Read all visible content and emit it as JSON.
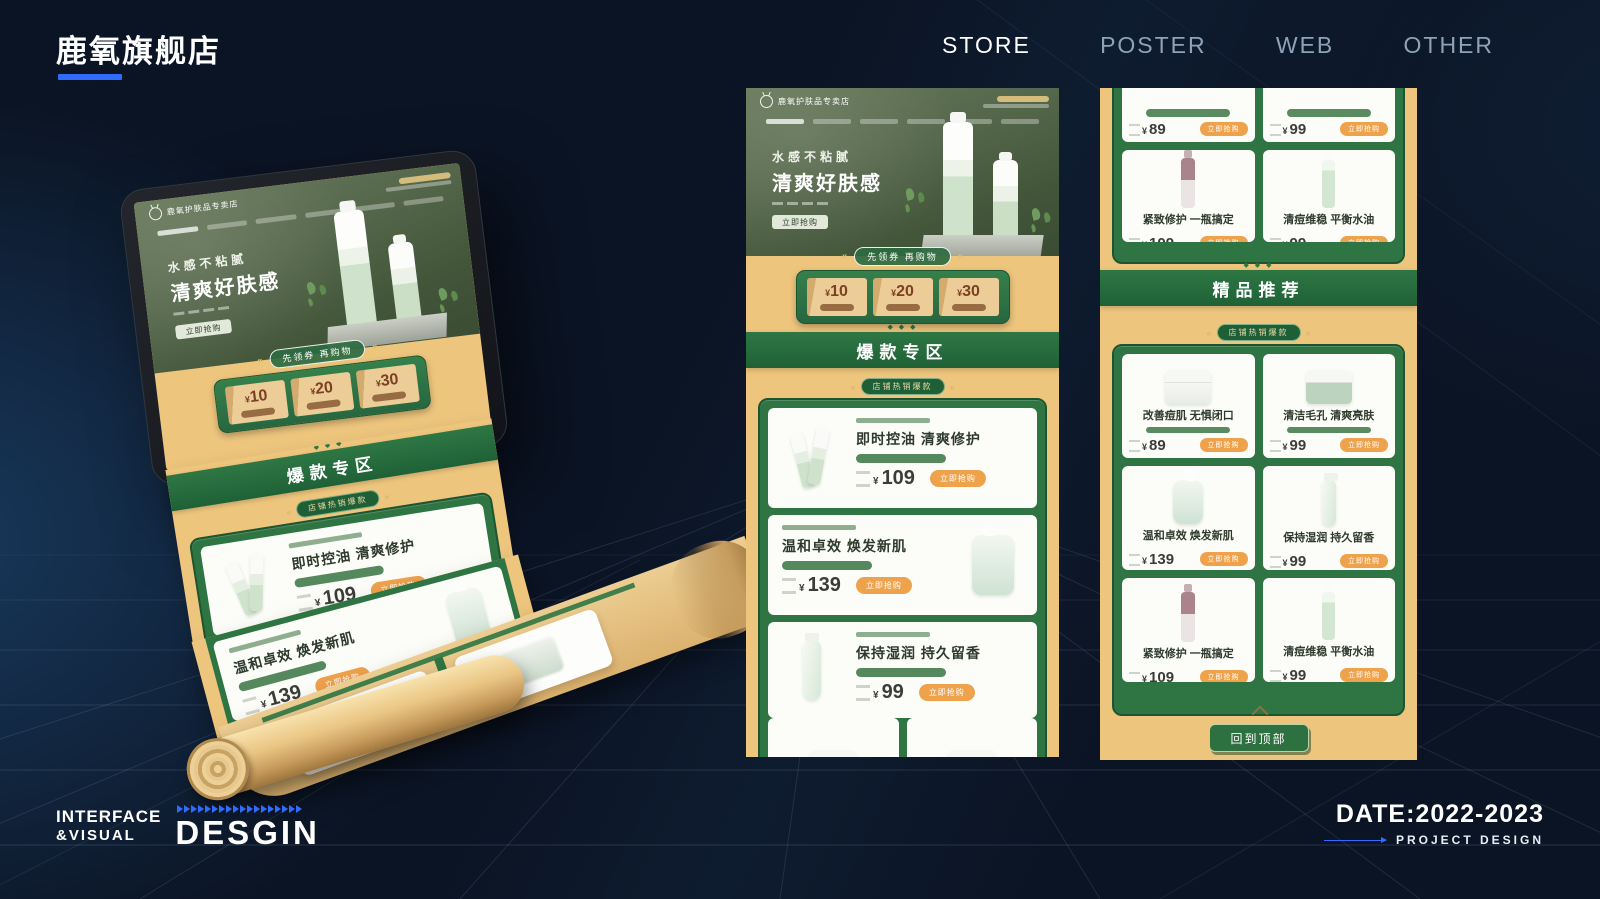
{
  "brand": {
    "title": "鹿氧旗舰店"
  },
  "nav": {
    "items": [
      {
        "label": "STORE",
        "active": true
      },
      {
        "label": "POSTER",
        "active": false
      },
      {
        "label": "WEB",
        "active": false
      },
      {
        "label": "OTHER",
        "active": false
      }
    ]
  },
  "footer": {
    "studio_line1": "INTERFACE",
    "studio_line2": "&VISUAL",
    "studio_big": "DESGIN",
    "date": "DATE:2022-2023",
    "project": "PROJECT DESIGN"
  },
  "store": {
    "shop_name": "鹿氧护肤品专卖店",
    "hero": {
      "line1": "水感不粘腻",
      "line2": "清爽好肤感",
      "cta": "立即抢购"
    },
    "coupon": {
      "ribbon": "先领券 再购物",
      "currency": "¥",
      "amounts": [
        "10",
        "20",
        "30"
      ]
    },
    "hot_zone_title": "爆款专区",
    "hot_badge": "店铺热销爆款",
    "featured_title": "精品推荐",
    "currency": "¥",
    "buy_label": "立即抢购",
    "back_to_top": "回到顶部",
    "hot_products": [
      {
        "title": "即时控油 清爽修护",
        "price": "109"
      },
      {
        "title": "温和卓效 焕发新肌",
        "price": "139"
      },
      {
        "title": "保持湿润 持久留香",
        "price": "99"
      }
    ],
    "partial_prices": [
      "89",
      "99"
    ],
    "featured_row": [
      {
        "title": "紧致修护 一瓶搞定",
        "price": "109"
      },
      {
        "title": "清痘维稳 平衡水油",
        "price": "99"
      }
    ],
    "grid_products": [
      {
        "title": "改善痘肌 无惧闭口",
        "price": "89"
      },
      {
        "title": "清洁毛孔 清爽亮肤",
        "price": "99"
      },
      {
        "title": "温和卓效 焕发新肌",
        "price": "139"
      },
      {
        "title": "保持湿润 持久留香",
        "price": "99"
      },
      {
        "title": "紧致修护 一瓶搞定",
        "price": "109"
      },
      {
        "title": "清痘维稳 平衡水油",
        "price": "99"
      }
    ]
  },
  "icons": {
    "deer_logo": "deer-outline-circle",
    "ribbon_arrows": "double-angle-quotes",
    "chevron_up": "caret-up",
    "footer_arrows": "blue-triangle-row"
  },
  "colors": {
    "accent_blue": "#2f6bff",
    "background_navy": "#0b1424",
    "page_yellow": "#edc57d",
    "band_green": "#256b3c",
    "panel_green": "#2f7543",
    "button_orange": "#efa24c"
  }
}
